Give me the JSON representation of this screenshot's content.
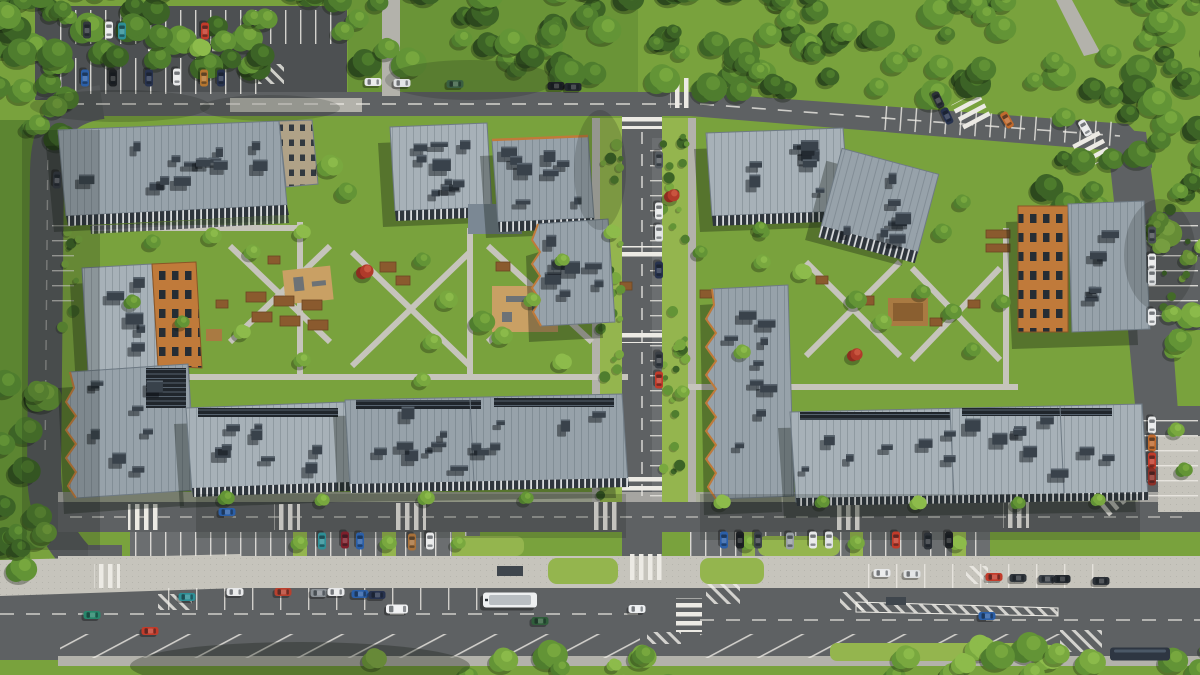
{
  "scene": {
    "label": "aerial-view-residential-complex-render"
  },
  "palette": {
    "grass": "#79a23d",
    "grassL": "#94b54e",
    "grassD": "#5c8531",
    "asphalt": "#5e6163",
    "asphalt2": "#4d5052",
    "lane": "#6b6e70",
    "paver": "#c6c4bc",
    "paver2": "#b3b2ab",
    "line": "#eceae4",
    "roof": "#97a2aa",
    "roofLight": "#a7b1b8",
    "orange": "#c07a3a",
    "roofbox": "#39424b",
    "roofboxTop": "#59646e",
    "accentTree": "#b03a2a"
  },
  "treeColors": [
    "#2c481d",
    "#3c6326",
    "#4f7d2e",
    "#639436",
    "#79a83f",
    "#8dbb4b"
  ],
  "vegetation": {
    "forest_bands": [
      {
        "x": -20,
        "y": -22,
        "w": 670,
        "h": 96,
        "n": 80,
        "dark": true
      },
      {
        "x": 640,
        "y": -22,
        "w": 580,
        "h": 118,
        "n": 85,
        "dark": true
      },
      {
        "x": 1030,
        "y": 60,
        "w": 180,
        "h": 150,
        "n": 26,
        "dark": true
      },
      {
        "x": -15,
        "y": -10,
        "w": 92,
        "h": 150,
        "n": 18,
        "dark": true
      },
      {
        "x": -15,
        "y": 360,
        "w": 66,
        "h": 230,
        "n": 16,
        "dark": true
      },
      {
        "x": 880,
        "y": 645,
        "w": 330,
        "h": 52,
        "n": 24,
        "dark": false
      },
      {
        "x": 360,
        "y": 654,
        "w": 320,
        "h": 38,
        "n": 10,
        "dark": false
      },
      {
        "x": 1152,
        "y": 200,
        "w": 58,
        "h": 150,
        "n": 10,
        "dark": false
      }
    ],
    "shrub_bands": [
      {
        "x": 600,
        "y": 125,
        "w": 22,
        "h": 375,
        "n": 30
      },
      {
        "x": 663,
        "y": 125,
        "w": 24,
        "h": 375,
        "n": 30
      },
      {
        "x": 62,
        "y": 220,
        "w": 18,
        "h": 110,
        "n": 8
      },
      {
        "x": 1158,
        "y": 205,
        "w": 30,
        "h": 130,
        "n": 10
      }
    ],
    "court_trees": [
      {
        "x": 330,
        "y": 166,
        "r": 12
      },
      {
        "x": 346,
        "y": 192,
        "r": 10
      },
      {
        "x": 302,
        "y": 232,
        "r": 8
      },
      {
        "x": 212,
        "y": 236,
        "r": 9
      },
      {
        "x": 252,
        "y": 252,
        "r": 8
      },
      {
        "x": 152,
        "y": 242,
        "r": 8
      },
      {
        "x": 365,
        "y": 272,
        "r": 9,
        "red": true
      },
      {
        "x": 422,
        "y": 260,
        "r": 8
      },
      {
        "x": 447,
        "y": 300,
        "r": 10
      },
      {
        "x": 482,
        "y": 322,
        "r": 12
      },
      {
        "x": 502,
        "y": 336,
        "r": 10
      },
      {
        "x": 432,
        "y": 342,
        "r": 9
      },
      {
        "x": 532,
        "y": 300,
        "r": 8
      },
      {
        "x": 562,
        "y": 260,
        "r": 7
      },
      {
        "x": 612,
        "y": 232,
        "r": 8
      },
      {
        "x": 672,
        "y": 196,
        "r": 8,
        "red": true
      },
      {
        "x": 700,
        "y": 252,
        "r": 7
      },
      {
        "x": 762,
        "y": 262,
        "r": 8
      },
      {
        "x": 802,
        "y": 272,
        "r": 9
      },
      {
        "x": 856,
        "y": 300,
        "r": 10
      },
      {
        "x": 882,
        "y": 322,
        "r": 9
      },
      {
        "x": 922,
        "y": 292,
        "r": 8
      },
      {
        "x": 952,
        "y": 312,
        "r": 9
      },
      {
        "x": 855,
        "y": 355,
        "r": 8,
        "red": true
      },
      {
        "x": 972,
        "y": 350,
        "r": 8
      },
      {
        "x": 1002,
        "y": 302,
        "r": 8
      },
      {
        "x": 942,
        "y": 232,
        "r": 9
      },
      {
        "x": 962,
        "y": 202,
        "r": 8
      },
      {
        "x": 762,
        "y": 232,
        "r": 7
      },
      {
        "x": 742,
        "y": 352,
        "r": 8
      },
      {
        "x": 682,
        "y": 392,
        "r": 7
      },
      {
        "x": 422,
        "y": 380,
        "r": 8
      },
      {
        "x": 302,
        "y": 360,
        "r": 8
      },
      {
        "x": 242,
        "y": 332,
        "r": 8
      },
      {
        "x": 182,
        "y": 322,
        "r": 7
      },
      {
        "x": 132,
        "y": 302,
        "r": 8
      },
      {
        "x": 562,
        "y": 362,
        "r": 9
      },
      {
        "x": 226,
        "y": 498,
        "r": 8
      },
      {
        "x": 322,
        "y": 500,
        "r": 7
      },
      {
        "x": 426,
        "y": 498,
        "r": 8
      },
      {
        "x": 526,
        "y": 498,
        "r": 7
      },
      {
        "x": 722,
        "y": 502,
        "r": 8
      },
      {
        "x": 822,
        "y": 502,
        "r": 7
      },
      {
        "x": 918,
        "y": 503,
        "r": 8
      },
      {
        "x": 1018,
        "y": 503,
        "r": 7
      },
      {
        "x": 1098,
        "y": 500,
        "r": 7
      },
      {
        "x": 299,
        "y": 543,
        "r": 8
      },
      {
        "x": 388,
        "y": 543,
        "r": 8
      },
      {
        "x": 458,
        "y": 543,
        "r": 7
      },
      {
        "x": 748,
        "y": 543,
        "r": 8
      },
      {
        "x": 856,
        "y": 543,
        "r": 8
      },
      {
        "x": 958,
        "y": 543,
        "r": 8
      },
      {
        "x": 560,
        "y": 668,
        "r": 9
      },
      {
        "x": 614,
        "y": 665,
        "r": 7
      },
      {
        "x": 200,
        "y": 48,
        "r": 10
      },
      {
        "x": 252,
        "y": 18,
        "r": 9
      },
      {
        "x": 760,
        "y": 228,
        "r": 7
      },
      {
        "x": 1176,
        "y": 430,
        "r": 8
      },
      {
        "x": 1184,
        "y": 470,
        "r": 8
      }
    ]
  },
  "roof_box_regions": [
    {
      "x": 72,
      "y": 140,
      "w": 196,
      "h": 52,
      "n": 14
    },
    {
      "x": 398,
      "y": 132,
      "w": 84,
      "h": 66,
      "n": 9
    },
    {
      "x": 500,
      "y": 146,
      "w": 84,
      "h": 62,
      "n": 8
    },
    {
      "x": 542,
      "y": 228,
      "w": 62,
      "h": 84,
      "n": 7
    },
    {
      "x": 716,
      "y": 140,
      "w": 120,
      "h": 62,
      "n": 9
    },
    {
      "x": 838,
      "y": 168,
      "w": 76,
      "h": 78,
      "n": 7
    },
    {
      "x": 1076,
      "y": 216,
      "w": 60,
      "h": 100,
      "n": 6
    },
    {
      "x": 92,
      "y": 276,
      "w": 58,
      "h": 80,
      "n": 5
    },
    {
      "x": 82,
      "y": 378,
      "w": 96,
      "h": 100,
      "n": 8
    },
    {
      "x": 196,
      "y": 414,
      "w": 140,
      "h": 64,
      "n": 8
    },
    {
      "x": 356,
      "y": 406,
      "w": 255,
      "h": 66,
      "n": 14
    },
    {
      "x": 716,
      "y": 296,
      "w": 66,
      "h": 188,
      "n": 9
    },
    {
      "x": 800,
      "y": 416,
      "w": 330,
      "h": 74,
      "n": 16
    }
  ],
  "vehicles": {
    "cars": [
      {
        "x": 87,
        "y": 30,
        "r": 90,
        "c": "#33383d"
      },
      {
        "x": 109,
        "y": 30,
        "r": 90,
        "c": "#e8e9ea"
      },
      {
        "x": 122,
        "y": 31,
        "r": 90,
        "c": "#2e8f96"
      },
      {
        "x": 205,
        "y": 31,
        "r": 90,
        "c": "#c23b2a"
      },
      {
        "x": 85,
        "y": 78,
        "r": 90,
        "c": "#2b5fa8"
      },
      {
        "x": 113,
        "y": 78,
        "r": 90,
        "c": "#1d2023"
      },
      {
        "x": 149,
        "y": 78,
        "r": 90,
        "c": "#27324e"
      },
      {
        "x": 177,
        "y": 77,
        "r": 90,
        "c": "#e8e9ea"
      },
      {
        "x": 204,
        "y": 78,
        "r": 90,
        "c": "#b5752f"
      },
      {
        "x": 221,
        "y": 78,
        "r": 90,
        "c": "#27324e"
      },
      {
        "x": 373,
        "y": 82,
        "r": 0,
        "c": "#e8e9ea"
      },
      {
        "x": 402,
        "y": 83,
        "r": 0,
        "c": "#dfe1e2"
      },
      {
        "x": 455,
        "y": 84,
        "r": 0,
        "c": "#3a5f41"
      },
      {
        "x": 556,
        "y": 86,
        "r": 0,
        "c": "#1d2023"
      },
      {
        "x": 573,
        "y": 87,
        "r": 0,
        "c": "#23282e"
      },
      {
        "x": 938,
        "y": 100,
        "r": 65,
        "c": "#2c3137"
      },
      {
        "x": 947,
        "y": 116,
        "r": 65,
        "c": "#27324e"
      },
      {
        "x": 1007,
        "y": 120,
        "r": 60,
        "c": "#c06a2e"
      },
      {
        "x": 1085,
        "y": 128,
        "r": 60,
        "c": "#e8e9ea"
      },
      {
        "x": 659,
        "y": 160,
        "r": 90,
        "c": "#555b60"
      },
      {
        "x": 659,
        "y": 211,
        "r": 90,
        "c": "#e8e9ea"
      },
      {
        "x": 659,
        "y": 233,
        "r": 90,
        "c": "#dfe1e2"
      },
      {
        "x": 659,
        "y": 270,
        "r": 90,
        "c": "#27324e"
      },
      {
        "x": 659,
        "y": 360,
        "r": 90,
        "c": "#3a3f45"
      },
      {
        "x": 659,
        "y": 380,
        "r": 90,
        "c": "#c23b2a"
      },
      {
        "x": 57,
        "y": 180,
        "r": 92,
        "c": "#2c3137"
      },
      {
        "x": 1152,
        "y": 235,
        "r": 90,
        "c": "#4a4f54"
      },
      {
        "x": 1152,
        "y": 262,
        "r": 90,
        "c": "#e8e9ea"
      },
      {
        "x": 1152,
        "y": 277,
        "r": 90,
        "c": "#d9dbdc"
      },
      {
        "x": 1152,
        "y": 317,
        "r": 90,
        "c": "#e8e9ea"
      },
      {
        "x": 1152,
        "y": 425,
        "r": 90,
        "c": "#e8e9ea"
      },
      {
        "x": 1152,
        "y": 443,
        "r": 90,
        "c": "#c06a2e"
      },
      {
        "x": 1152,
        "y": 461,
        "r": 90,
        "c": "#c23b2a"
      },
      {
        "x": 1152,
        "y": 477,
        "r": 90,
        "c": "#8c2f27"
      },
      {
        "x": 227,
        "y": 512,
        "r": 0,
        "c": "#2b5fa8"
      },
      {
        "x": 322,
        "y": 541,
        "r": 90,
        "c": "#2e8f96"
      },
      {
        "x": 345,
        "y": 540,
        "r": 90,
        "c": "#7e1f2b"
      },
      {
        "x": 360,
        "y": 541,
        "r": 90,
        "c": "#2b5fa8"
      },
      {
        "x": 412,
        "y": 542,
        "r": 90,
        "c": "#a8713a"
      },
      {
        "x": 430,
        "y": 541,
        "r": 90,
        "c": "#e8e9ea"
      },
      {
        "x": 724,
        "y": 540,
        "r": 90,
        "c": "#2b5fa8"
      },
      {
        "x": 740,
        "y": 540,
        "r": 90,
        "c": "#1d2023"
      },
      {
        "x": 758,
        "y": 540,
        "r": 90,
        "c": "#3d434a"
      },
      {
        "x": 790,
        "y": 541,
        "r": 90,
        "c": "#9aa0a6"
      },
      {
        "x": 813,
        "y": 540,
        "r": 90,
        "c": "#e8e9ea"
      },
      {
        "x": 829,
        "y": 540,
        "r": 90,
        "c": "#dfe1e2"
      },
      {
        "x": 896,
        "y": 540,
        "r": 90,
        "c": "#c23b2a"
      },
      {
        "x": 928,
        "y": 541,
        "r": 90,
        "c": "#2c3137"
      },
      {
        "x": 949,
        "y": 540,
        "r": 90,
        "c": "#1d2023"
      },
      {
        "x": 187,
        "y": 597,
        "r": 0,
        "c": "#2e8f96"
      },
      {
        "x": 235,
        "y": 592,
        "r": 0,
        "c": "#e8e9ea"
      },
      {
        "x": 283,
        "y": 592,
        "r": 0,
        "c": "#b8402e"
      },
      {
        "x": 319,
        "y": 593,
        "r": 0,
        "c": "#8b9196"
      },
      {
        "x": 336,
        "y": 592,
        "r": 0,
        "c": "#e8e9ea"
      },
      {
        "x": 360,
        "y": 594,
        "r": 0,
        "c": "#2b5fa8"
      },
      {
        "x": 377,
        "y": 595,
        "r": 0,
        "c": "#27324e"
      },
      {
        "x": 397,
        "y": 609,
        "r": 0,
        "c": "#f0f1f2",
        "w": 22,
        "h": 9
      },
      {
        "x": 882,
        "y": 573,
        "r": 0,
        "c": "#e8e9ea"
      },
      {
        "x": 912,
        "y": 574,
        "r": 0,
        "c": "#dfe1e2"
      },
      {
        "x": 994,
        "y": 577,
        "r": 0,
        "c": "#c23b2a"
      },
      {
        "x": 1018,
        "y": 578,
        "r": 0,
        "c": "#30363c"
      },
      {
        "x": 1047,
        "y": 579,
        "r": 0,
        "c": "#3d434a"
      },
      {
        "x": 1062,
        "y": 579,
        "r": 0,
        "c": "#23282e"
      },
      {
        "x": 1101,
        "y": 581,
        "r": 0,
        "c": "#2c3137"
      },
      {
        "x": 92,
        "y": 615,
        "r": 0,
        "c": "#27876b"
      },
      {
        "x": 150,
        "y": 631,
        "r": 0,
        "c": "#c23b2a"
      },
      {
        "x": 540,
        "y": 621,
        "r": 0,
        "c": "#2f5d3a"
      },
      {
        "x": 637,
        "y": 609,
        "r": 0,
        "c": "#eceef0"
      },
      {
        "x": 987,
        "y": 616,
        "r": 0,
        "c": "#2b5fa8"
      }
    ],
    "bus": {
      "x": 510,
      "y": 600,
      "w": 54,
      "h": 15,
      "c": "#eef0f1"
    },
    "dark_bus": {
      "x": 1140,
      "y": 654,
      "w": 60,
      "h": 13,
      "c": "#2e3642"
    }
  }
}
